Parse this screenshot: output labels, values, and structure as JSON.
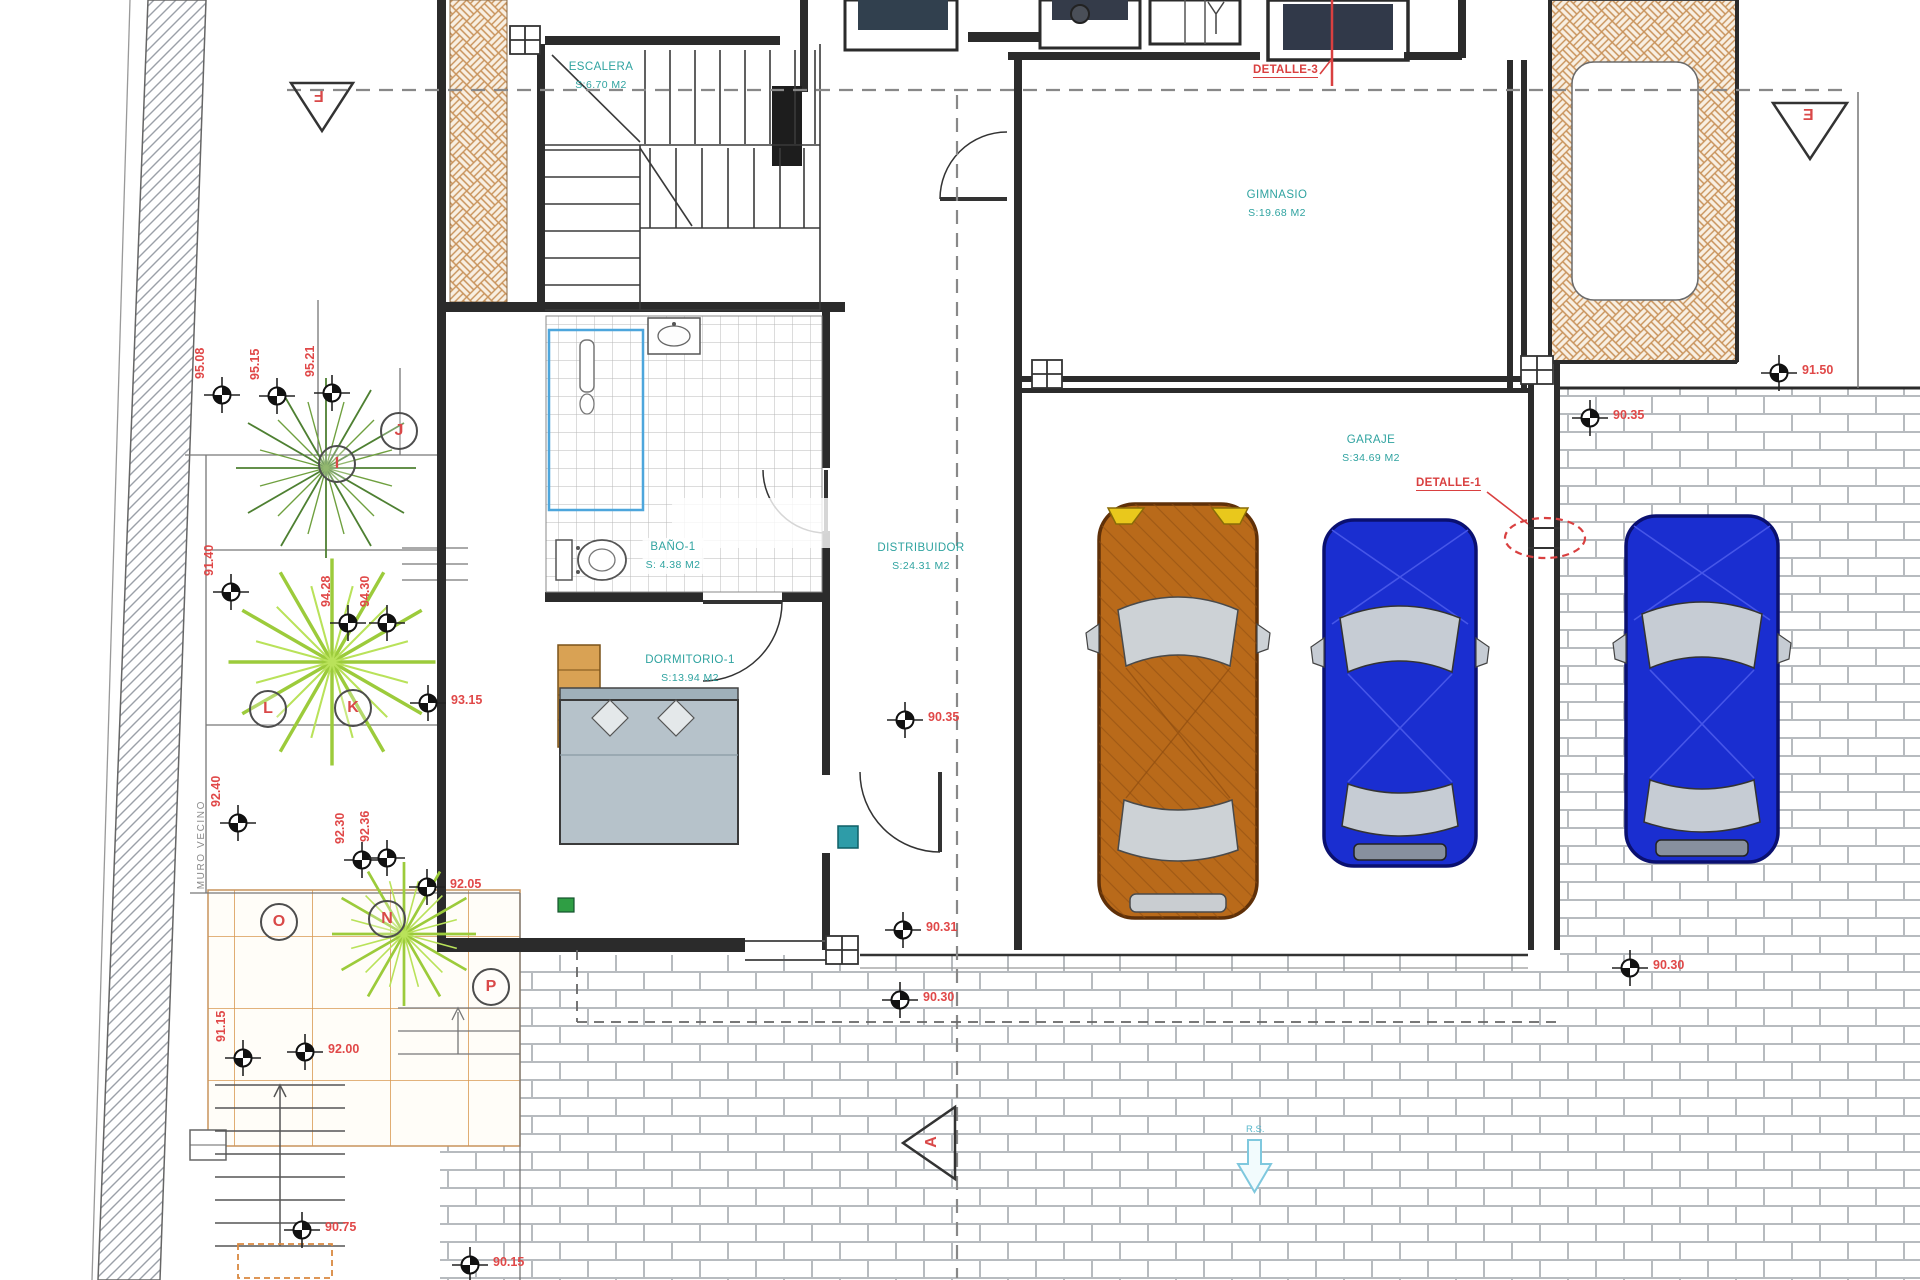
{
  "plan": {
    "title": "Planta baja - vivienda con garaje",
    "rooms": [
      {
        "id": "escalera",
        "name": "ESCALERA",
        "area": "S:6.70 M2",
        "x": 601,
        "y": 76
      },
      {
        "id": "gimnasio",
        "name": "GIMNASIO",
        "area": "S:19.68 M2",
        "x": 1277,
        "y": 204
      },
      {
        "id": "bano",
        "name": "BAÑO-1",
        "area": "S: 4.38 M2",
        "x": 673,
        "y": 556
      },
      {
        "id": "distribuidor",
        "name": "DISTRIBUIDOR",
        "area": "S:24.31 M2",
        "x": 921,
        "y": 557
      },
      {
        "id": "dormitorio",
        "name": "DORMITORIO-1",
        "area": "S:13.94 M2",
        "x": 690,
        "y": 669
      },
      {
        "id": "garaje",
        "name": "GARAJE",
        "area": "S:34.69 M2",
        "x": 1371,
        "y": 449
      }
    ],
    "details": {
      "detalle_1": "DETALLE-1",
      "detalle_3": "DETALLE-3"
    },
    "section_letters": {
      "f": "F",
      "e": "E",
      "a": "A"
    },
    "annotations": {
      "muro_vecino": "MURO VECINO",
      "rs": "R.S."
    },
    "circle_letters": [
      {
        "letter": "J",
        "x": 397,
        "y": 429
      },
      {
        "letter": "I",
        "x": 335,
        "y": 462
      },
      {
        "letter": "L",
        "x": 266,
        "y": 707
      },
      {
        "letter": "K",
        "x": 351,
        "y": 706
      },
      {
        "letter": "O",
        "x": 277,
        "y": 920
      },
      {
        "letter": "N",
        "x": 385,
        "y": 917
      },
      {
        "letter": "P",
        "x": 489,
        "y": 985
      }
    ],
    "elevation_markers": [
      {
        "x": 222,
        "y": 395,
        "v": "95.08",
        "o": "u"
      },
      {
        "x": 277,
        "y": 396,
        "v": "95.15",
        "o": "u"
      },
      {
        "x": 332,
        "y": 393,
        "v": "95.21",
        "o": "u"
      },
      {
        "x": 231,
        "y": 592,
        "v": "91.40",
        "o": "u"
      },
      {
        "x": 348,
        "y": 623,
        "v": "94.28",
        "o": "u"
      },
      {
        "x": 387,
        "y": 623,
        "v": "94.30",
        "o": "u"
      },
      {
        "x": 428,
        "y": 703,
        "v": "93.15",
        "o": "r"
      },
      {
        "x": 238,
        "y": 823,
        "v": "92.40",
        "o": "u"
      },
      {
        "x": 362,
        "y": 860,
        "v": "92.30",
        "o": "u"
      },
      {
        "x": 387,
        "y": 858,
        "v": "92.36",
        "o": "u"
      },
      {
        "x": 427,
        "y": 887,
        "v": "92.05",
        "o": "r"
      },
      {
        "x": 305,
        "y": 1052,
        "v": "92.00",
        "o": "r"
      },
      {
        "x": 243,
        "y": 1058,
        "v": "91.15",
        "o": "u"
      },
      {
        "x": 302,
        "y": 1230,
        "v": "90.75",
        "o": "r"
      },
      {
        "x": 470,
        "y": 1265,
        "v": "90.15",
        "o": "r"
      },
      {
        "x": 905,
        "y": 720,
        "v": "90.35",
        "o": "r"
      },
      {
        "x": 903,
        "y": 930,
        "v": "90.31",
        "o": "r"
      },
      {
        "x": 900,
        "y": 1000,
        "v": "90.30",
        "o": "r"
      },
      {
        "x": 1590,
        "y": 418,
        "v": "90.35",
        "o": "r"
      },
      {
        "x": 1779,
        "y": 373,
        "v": "91.50",
        "o": "r"
      },
      {
        "x": 1630,
        "y": 968,
        "v": "90.30",
        "o": "r"
      }
    ],
    "colors": {
      "label_teal": "#2FA3A0",
      "annotation_red": "#D94040",
      "car_orange": "#B96A1A",
      "car_blue": "#1A2ED0",
      "hatch_orange": "#C8925A",
      "plant_dark": "#4E8032",
      "plant_lime": "#9CCB3B"
    }
  }
}
